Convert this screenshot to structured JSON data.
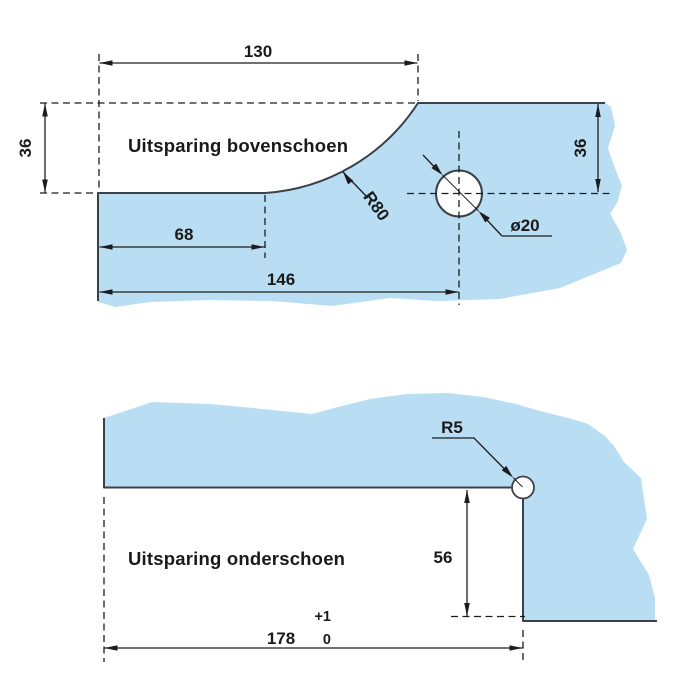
{
  "colors": {
    "background": "#ffffff",
    "glass_fill": "#b9def3",
    "edge_stroke": "#3a4148",
    "dim_stroke": "#1c1c1c",
    "label_color": "#1a1a1a"
  },
  "top_view": {
    "title": "Uitsparing bovenschoen",
    "dims": {
      "cutout_width": "130",
      "cutout_depth": "36",
      "flat_length": "68",
      "hole_center_distance": "146",
      "corner_radius": "R80",
      "hole_diameter": "ø20",
      "hole_edge_distance": "36"
    }
  },
  "bottom_view": {
    "title": "Uitsparing onderschoen",
    "dims": {
      "notch_radius": "R5",
      "step_height": "56",
      "step_width": "178",
      "tolerance_plus": "+1",
      "tolerance_zero": "0"
    }
  }
}
